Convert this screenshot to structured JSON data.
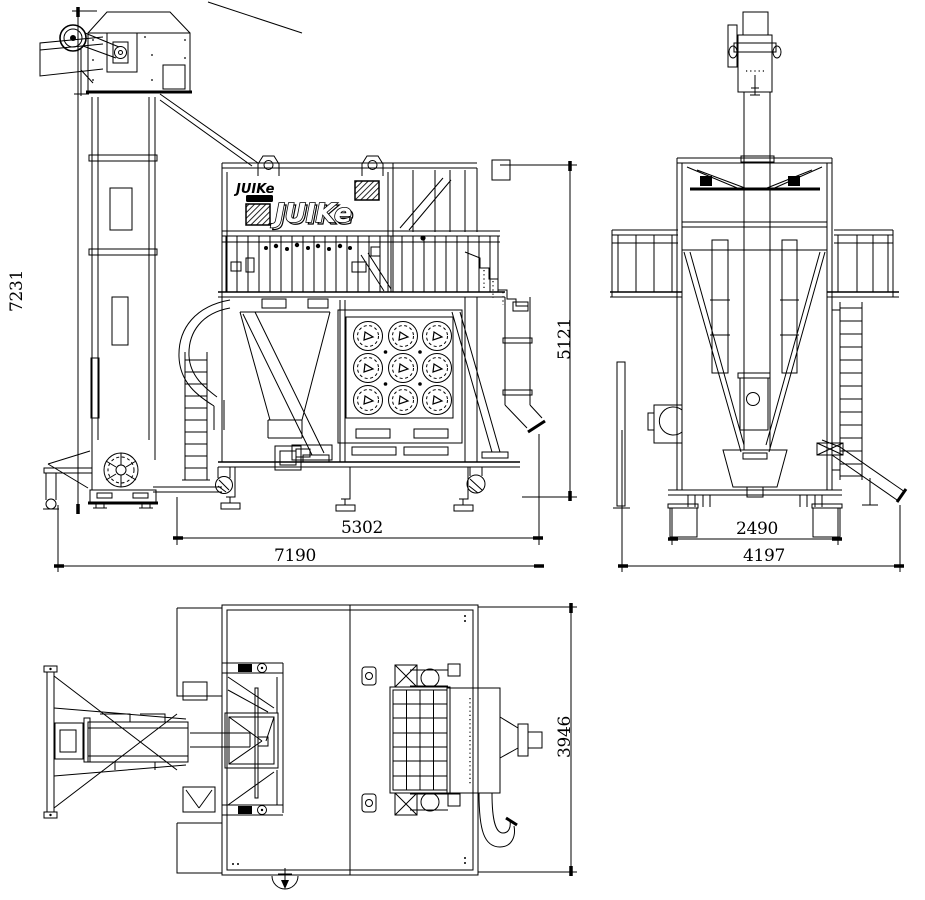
{
  "drawing": {
    "brand_logo_small": "JUIKe",
    "brand_logo_large": "JUIKe",
    "views": {
      "front": {
        "dim_total_height": "7231",
        "dim_inner_width": "5302",
        "dim_total_width": "7190",
        "dim_body_height": "5121"
      },
      "side": {
        "dim_inner_width": "2490",
        "dim_total_width": "4197"
      },
      "top": {
        "dim_depth": "3946"
      }
    },
    "colors": {
      "line": "#000000",
      "background": "#ffffff"
    }
  }
}
